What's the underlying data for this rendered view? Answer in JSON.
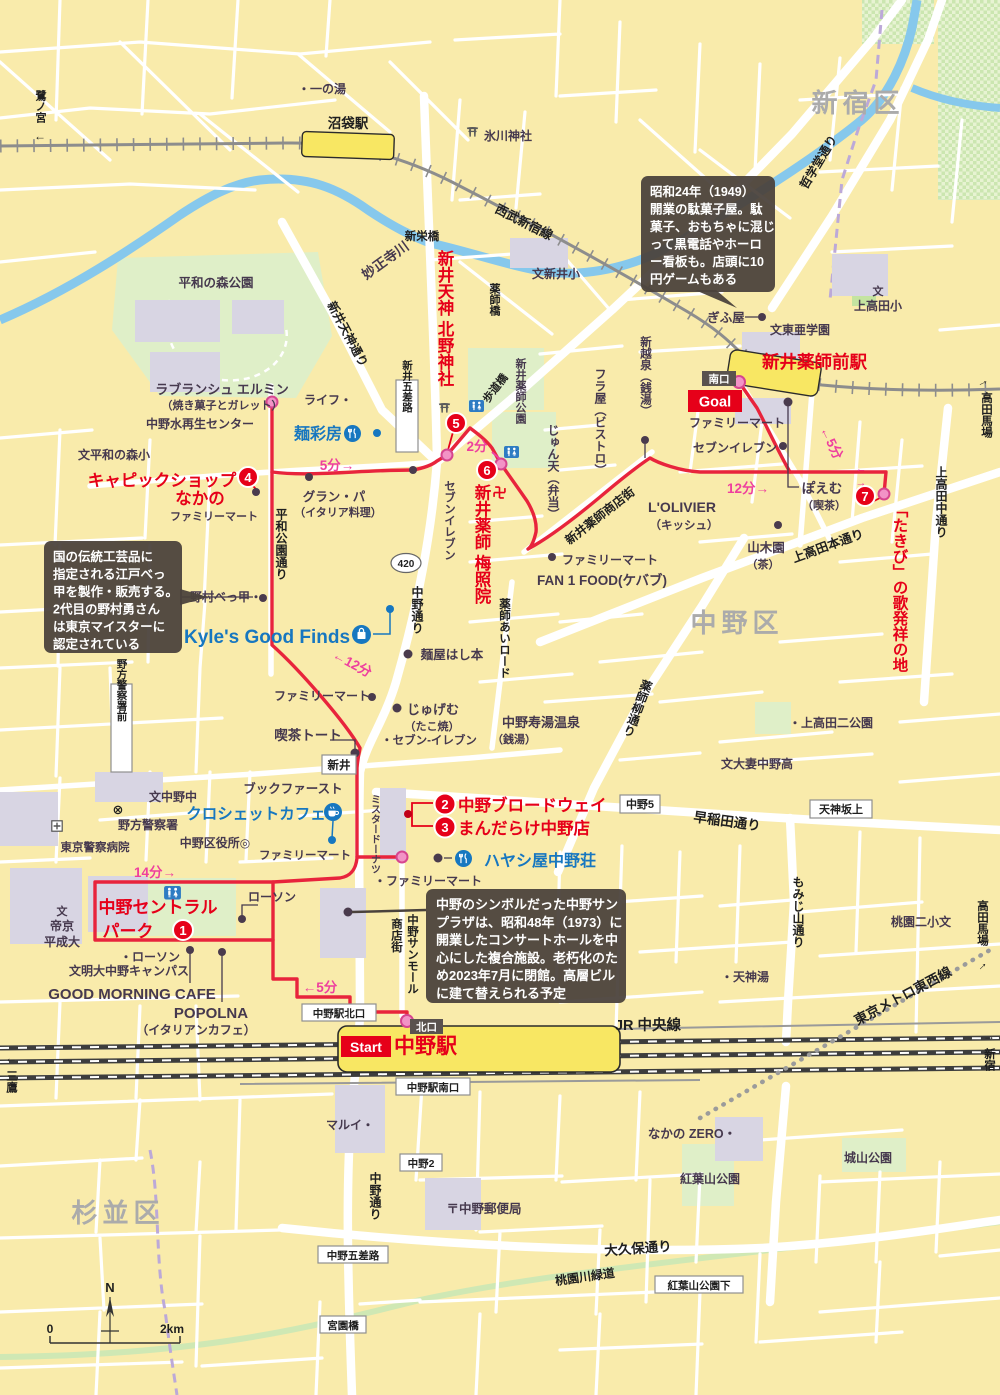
{
  "districts": {
    "shinjuku": "新宿区",
    "nakano": "中野区",
    "suginami": "杉並区"
  },
  "stations": {
    "numabukuro": "沼袋駅",
    "arai_yakushimae": "新井薬師前駅",
    "nakano": "中野駅"
  },
  "route": {
    "start": "Start",
    "goal": "Goal",
    "north_exit": "北口",
    "south_exit": "南口",
    "stops": [
      {
        "num": "1",
        "name": "中野セントラルパーク"
      },
      {
        "num": "2",
        "name": "中野ブロードウェイ"
      },
      {
        "num": "3",
        "name": "まんだらけ中野店"
      },
      {
        "num": "4",
        "name": "キャピックショップなかの"
      },
      {
        "num": "5",
        "name": "新井天神 北野神社"
      },
      {
        "num": "6",
        "name": "新井薬師 梅照院"
      },
      {
        "num": "7",
        "name": "「たきび」の歌発祥の地"
      }
    ],
    "times": {
      "start_to_1": "←5分",
      "p1_to_2": "14分→",
      "to_kyles": "←12分",
      "p4_to_5": "5分→",
      "p5_to_6": "2分",
      "p6_to_7": "12分→",
      "p7_to_goal": "←5分"
    }
  },
  "stop_labels": {
    "s1a": "中野セントラル",
    "s1b": "パーク",
    "s2": "中野ブロードウェイ",
    "s3": "まんだらけ中野店",
    "s4a": "キャピックショップ",
    "s4b": "なかの",
    "s5": "新井天神 北野神社",
    "s6": "新井薬師 梅照院",
    "s7": "「たきび」の歌発祥の地"
  },
  "rails": {
    "seibu": "西武新宿線",
    "jr": "JR 中央線",
    "metro": "東京メトロ東西線"
  },
  "waterways": {
    "myoshoji": "妙正寺川"
  },
  "roads": {
    "tetsugakudo": "哲学堂通り",
    "arai_tenjin": "新井天神通り",
    "nakano_dori": "中野通り",
    "r420": "420",
    "heiwa_koen": "平和公園通り",
    "yakushi_ai": "薬師あいロード",
    "yakushi_yanagi": "薬師柳通り",
    "yakushi_shotengai": "新井薬師商店街",
    "kamitakada_hon": "上高田本通り",
    "kamitakada_naka": "上高田中通り",
    "waseda": "早稲田通り",
    "okubo": "大久保通り",
    "momijiyama": "もみじ山通り",
    "sunmall": "中野サンモール",
    "sunmall2": "商店街",
    "momozonogawa": "桃園川緑道",
    "mrdonut": "ミスタードーナツ"
  },
  "signs": {
    "shineibashi": "新栄橋",
    "yakushibashi": "薬師橋",
    "hodokyo": "歩道橋",
    "arai": "新井",
    "arai_gosaro": "新井五差路",
    "nakano5": "中野5",
    "tenjin_sakaue": "天神坂上",
    "nakano_kita": "中野駅北口",
    "nakano_minami": "中野駅南口",
    "nakano2": "中野2",
    "nakano_gosaro": "中野五差路",
    "miyazono": "宮園橋",
    "momijishita": "紅葉山公園下",
    "nogata_mae": "野方警察署前"
  },
  "edges": {
    "saginomiya": "鷺ノ宮",
    "takadanobaba": "高田馬場",
    "shinjuku": "新宿",
    "mitaka": "三鷹",
    "left": "←",
    "right": "→"
  },
  "pois": {
    "ichinoyu": "・一の湯",
    "hikawa": "氷川神社",
    "arai_sho": "文新井小",
    "heiwanomori_park": "平和の森公園",
    "heiwanomori_sho": "文平和の森小",
    "labranche": "ラブランシュ エルミン",
    "labranche_sub": "（焼き菓子とガレット）",
    "life": "ライフ・",
    "mizusaisei": "中野水再生センター",
    "mensaibo": "麺彩房",
    "familymart": "ファミリーマート",
    "familymart_dot2": "・ファミリーマート",
    "grandpa": "グラン・パ",
    "grandpa_sub": "（イタリア料理）",
    "seveneleven": "セブンイレブン",
    "seveneleven_dot": "セブンイレブン・",
    "seveneleven_mid": "・セブン-イレブン",
    "araiyakushi_park": "新井薬師公園",
    "junten": "じゅん天（弁当）",
    "fraya": "フラ屋（ビストロ）",
    "shinkoshiizumi": "新越泉（銭湯）",
    "gifuya": "ぎふ屋",
    "toagakuen": "文東亜学園",
    "mon": "文",
    "kamitakada_sho": "上高田小",
    "poem": "ぽえむ",
    "poem_sub": "（喫茶）",
    "yamakien": "山木園",
    "yamakien_sub": "（茶）",
    "lolivier": "L'OLIVIER",
    "lolivier_sub": "（キッシュ）",
    "fan1food": "FAN 1 FOOD(ケバブ)",
    "sujiyu": "中野寿湯温泉",
    "sujiyu_sub": "（銭湯）",
    "menya": "麺屋はし本",
    "jugemu": "じゅげむ",
    "jugemu_sub": "（たこ焼）",
    "toto": "喫茶トート",
    "kyles": "Kyle's Good Finds",
    "nomura": "野村べっ甲・",
    "bookfirst": "ブックファースト",
    "crochet": "クロシェットカフェ",
    "nakano_chu": "文中野中",
    "nogata_police": "野方警察署",
    "police_x": "⊗",
    "police_hosp": "東京警察病院",
    "kuyakusho": "中野区役所◎",
    "lawson": "ローソン",
    "lawson_dot": "・ローソン",
    "teikyo_mon": "文",
    "teikyo1": "帝京",
    "teikyo2": "平成大",
    "meidai": "文明大中野キャンパス",
    "gmc": "GOOD MORNING CAFE",
    "popolna": "POPOLNA",
    "popolna_sub": "（イタリアンカフェ）",
    "hayashiya": "ハヤシ屋中野荘",
    "marui": "マルイ・",
    "postoffice": "〒中野郵便局",
    "nakano_zero": "なかの ZERO・",
    "momijiyama_park": "紅葉山公園",
    "shiroyama_park": "城山公園",
    "tenjinyu": "・天神湯",
    "momozono_nisho": "桃園二小文",
    "otsuma": "文大妻中野高",
    "kamitakada_niko": "・上高田二公園"
  },
  "notes": {
    "dagashiya": [
      "昭和24年（1949）",
      "開業の駄菓子屋。駄",
      "菓子、おもちゃに混じ",
      "って黒電話やホーロ",
      "ー看板も。店頭に10",
      "円ゲームもある"
    ],
    "bekko": [
      "国の伝統工芸品に",
      "指定される江戸べっ",
      "甲を製作・販売する。",
      "2代目の野村勇さん",
      "は東京マイスターに",
      "認定されている"
    ],
    "sunplaza": [
      "中野のシンボルだった中野サン",
      "プラザは、昭和48年（1973）に",
      "開業したコンサートホールを中",
      "心にした複合施設。老朽化のた",
      "め2023年7月に閉館。高層ビル",
      "に建て替えられる予定"
    ]
  },
  "legend": {
    "north": "N",
    "scale_start": "0",
    "scale_end": "2km"
  },
  "icons": {
    "wc": "restroom",
    "food": "restaurant",
    "cafe": "coffee-cup",
    "bag": "shopping-bag",
    "torii": "shrine",
    "manji": "temple",
    "hospital": "hospital-cross"
  },
  "colors": {
    "route": "#e8243c",
    "stop_badge": "#e60019",
    "time_label": "#ee3f9e",
    "shop_blue": "#1777c0",
    "water": "#86c8ec",
    "park": "#dfefc8",
    "station_fill": "#f8e763"
  }
}
